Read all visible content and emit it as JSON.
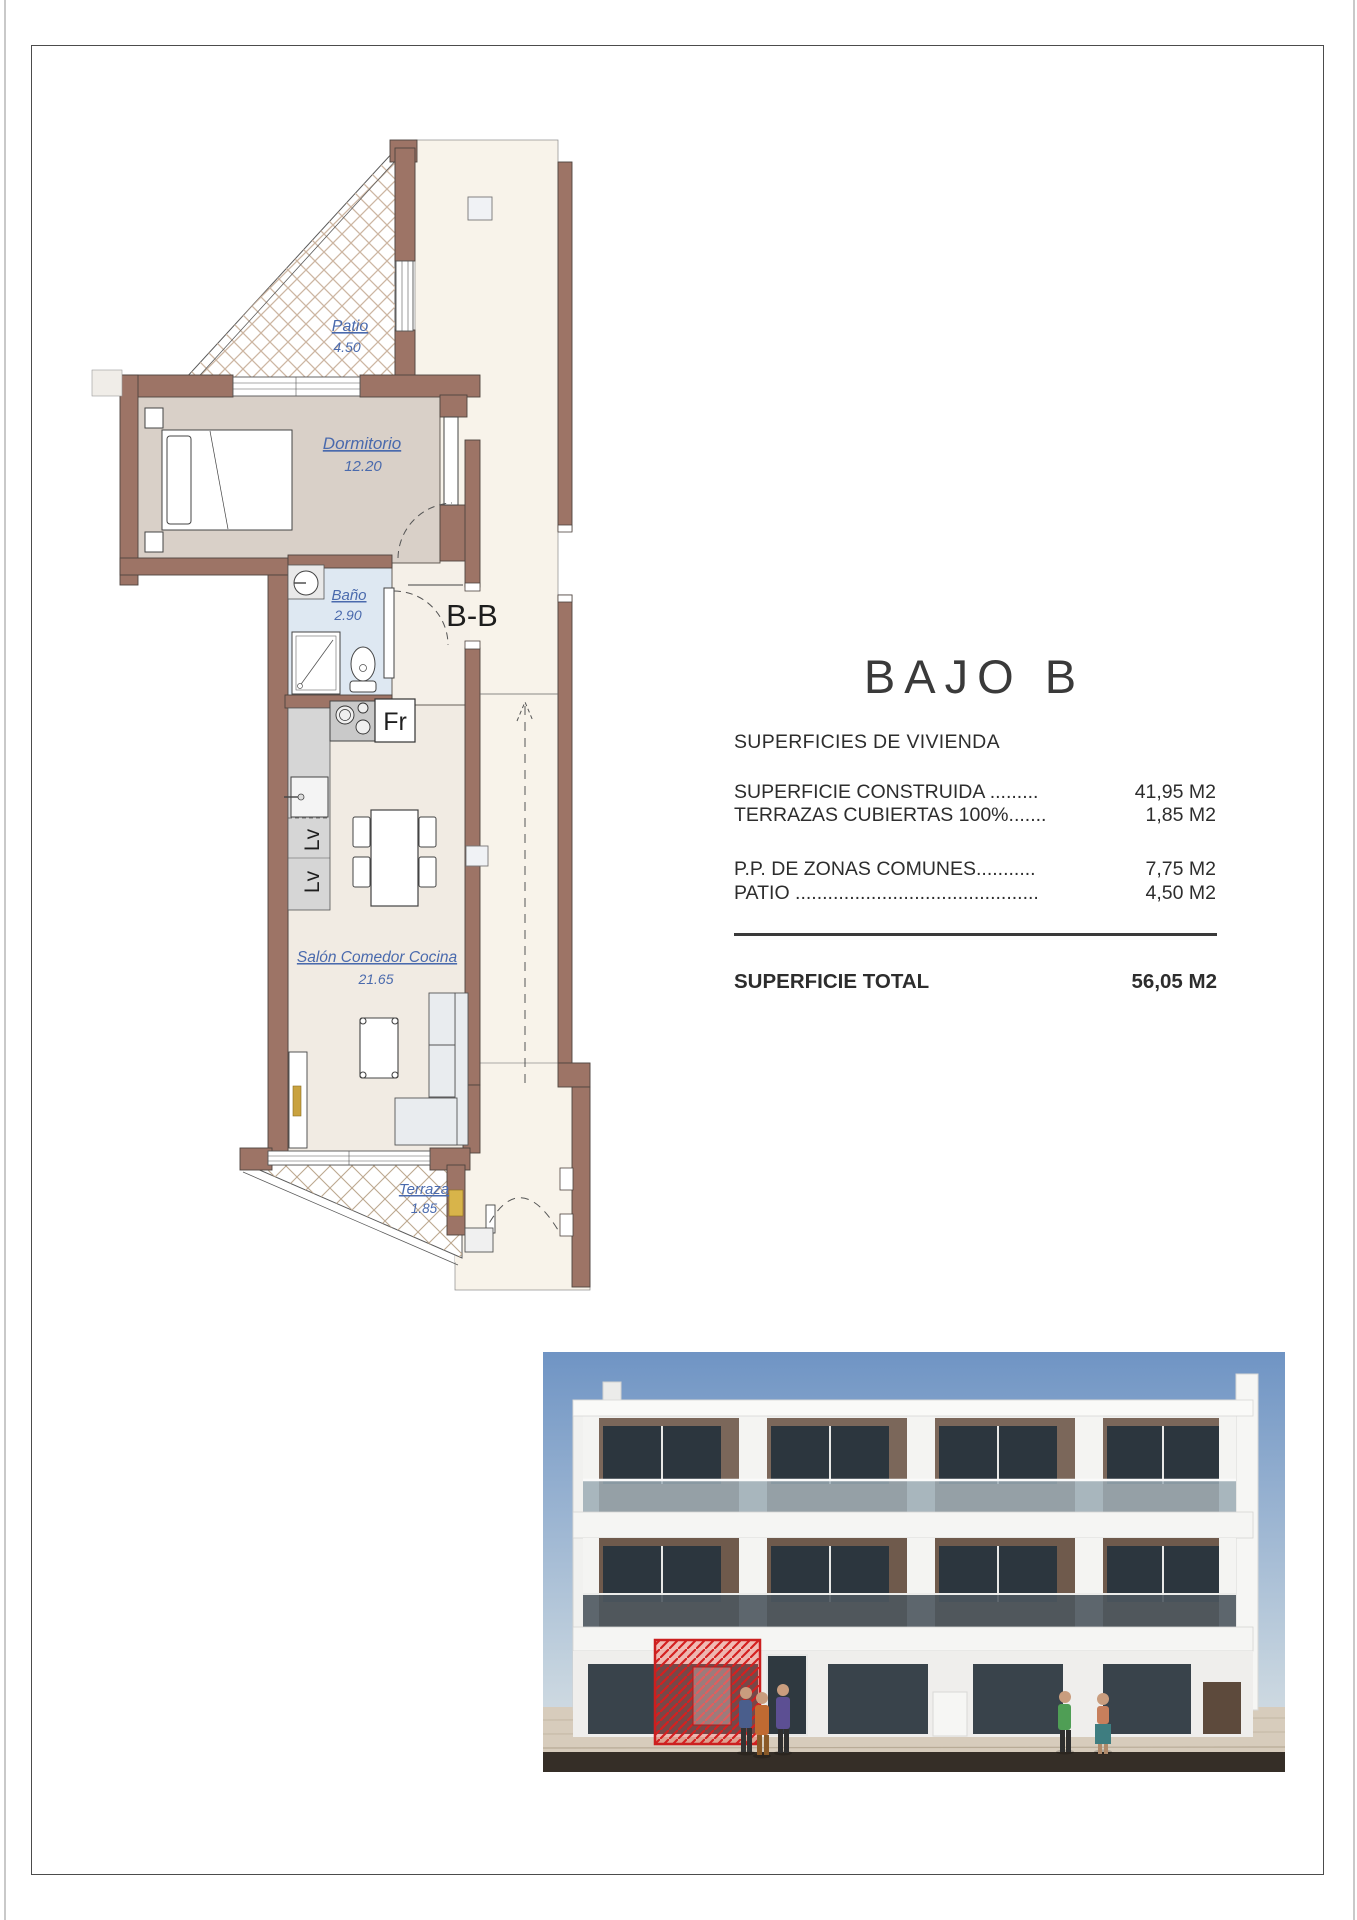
{
  "document": {
    "title": "BAJO B",
    "subtitle": "SUPERFICIES DE VIVIENDA",
    "area_rows": [
      {
        "label": "SUPERFICIE CONSTRUIDA .........",
        "value": "41,95 M2"
      },
      {
        "label": "TERRAZAS CUBIERTAS 100%.......",
        "value": "1,85 M2"
      },
      {
        "label": "P.P. DE ZONAS COMUNES...........",
        "value": "7,75 M2"
      },
      {
        "label": "PATIO .............................................",
        "value": "4,50 M2"
      }
    ],
    "total": {
      "label": "SUPERFICIE TOTAL",
      "value": "56,05 M2"
    }
  },
  "floor_plan": {
    "section_label": "B-B",
    "fridge_label": "Fr",
    "appliance_label": "Lv",
    "rooms": [
      {
        "name": "Patio",
        "area": "4.50"
      },
      {
        "name": "Dormitorio",
        "area": "12.20"
      },
      {
        "name": "Baño",
        "area": "2.90"
      },
      {
        "name": "Salón Comedor Cocina",
        "area": "21.65"
      },
      {
        "name": "Terraza",
        "area": "1.85"
      }
    ]
  },
  "colors": {
    "wall": "#9d7466",
    "room_label": "#4a6aad",
    "bath_floor": "#dee8f2",
    "bedroom_floor": "#d9d0c8",
    "living_floor": "#f1ebe3",
    "corridor_floor": "#f8f3ea",
    "highlight_red": "#d93025"
  }
}
